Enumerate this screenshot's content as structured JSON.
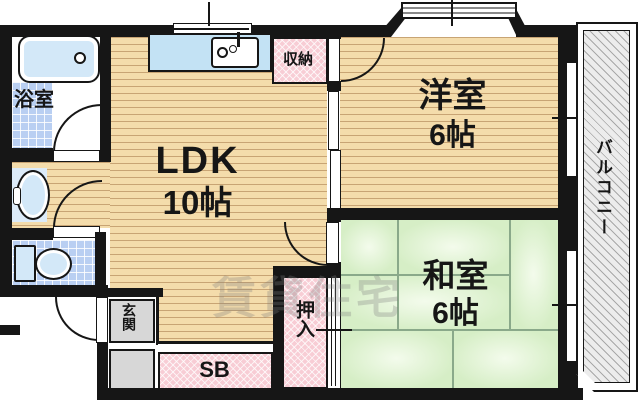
{
  "rooms": {
    "ldk": {
      "name": "LDK",
      "size": "10帖"
    },
    "western": {
      "name": "洋室",
      "size": "6帖"
    },
    "japanese": {
      "name": "和室",
      "size": "6帖"
    },
    "bathroom": {
      "name": "浴室"
    },
    "balcony": {
      "name": "バルコニー"
    },
    "entrance": {
      "name": "玄関"
    },
    "storage": {
      "name": "収納"
    },
    "oshiire": {
      "name": "押入"
    },
    "shoebox": {
      "name": "SB"
    }
  },
  "watermark": "賃貸住宅",
  "colors": {
    "wall": "#161616",
    "wood_floor": "#f4dcab",
    "tatami": "#d6eec6",
    "tile": "#b9cff2",
    "closet_pink": "#f8cdd5",
    "entrance_gray": "#d7d7d7",
    "balcony_gray": "#ececec",
    "fixture_blue": "#d3e8f8"
  }
}
